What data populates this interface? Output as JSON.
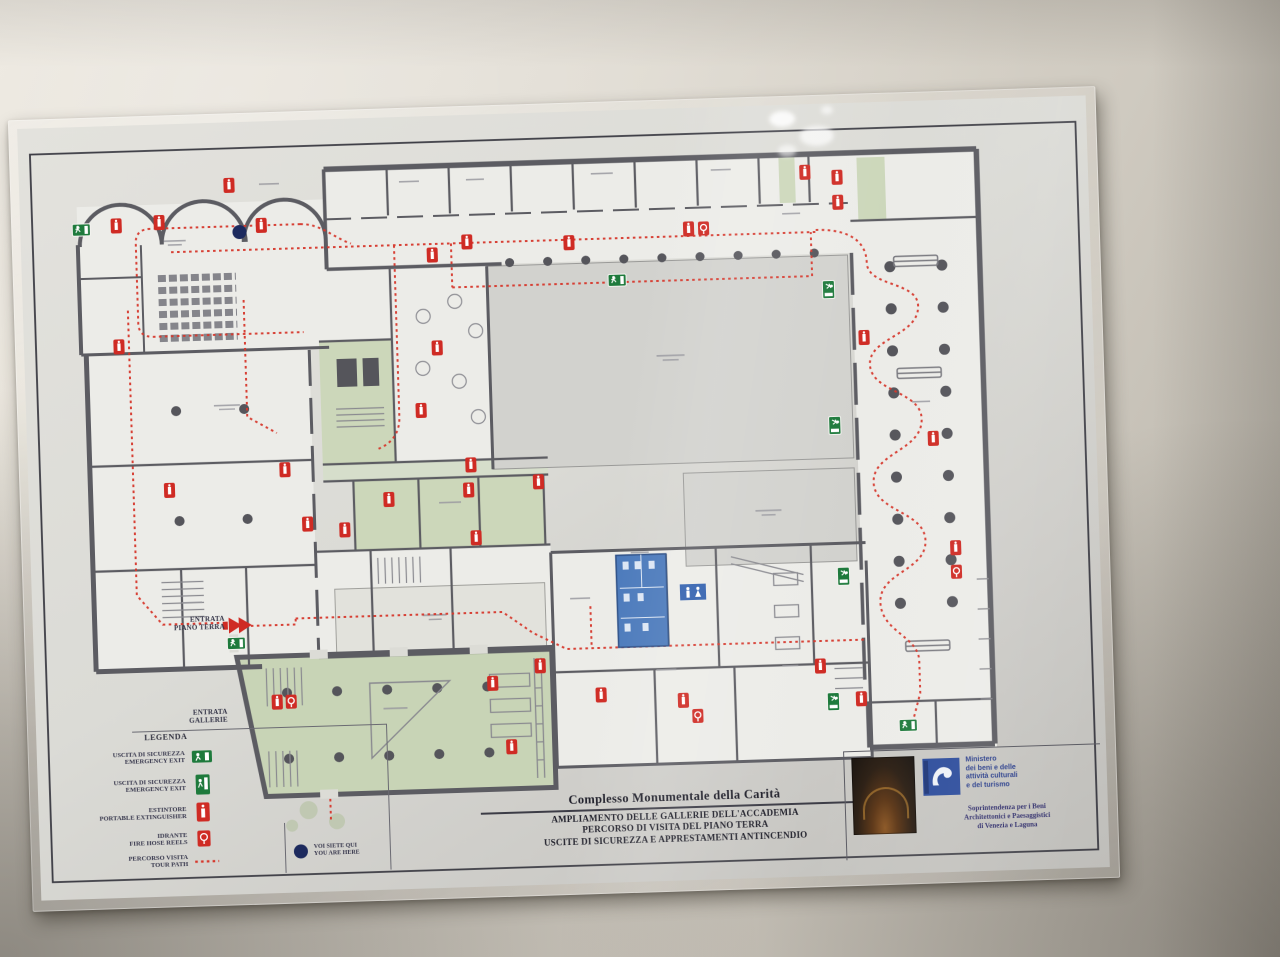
{
  "poster": {
    "entrances": {
      "ground_floor": {
        "line1": "ENTRATA",
        "line2": "PIANO TERRA"
      },
      "galleries": {
        "line1": "ENTRATA",
        "line2": "GALLERIE"
      }
    },
    "legend": {
      "title": "LEGENDA",
      "items": [
        {
          "id": "emergency-exit-horizontal",
          "it": "USCITA DI SICUREZZA",
          "en": "EMERGENCY EXIT"
        },
        {
          "id": "emergency-exit-vertical",
          "it": "USCITA DI SICUREZZA",
          "en": "EMERGENCY EXIT"
        },
        {
          "id": "fire-extinguisher",
          "it": "ESTINTORE",
          "en": "PORTABLE EXTINGUISHER"
        },
        {
          "id": "fire-hose-reel",
          "it": "IDRANTE",
          "en": "FIRE HOSE REELS"
        },
        {
          "id": "tour-path",
          "it": "PERCORSO VISITA",
          "en": "TOUR PATH"
        }
      ],
      "you_are_here": {
        "it": "VOI SIETE QUI",
        "en": "YOU ARE HERE",
        "icon": "blue-dot"
      }
    },
    "title_block": {
      "heading": "Complesso Monumentale della Carità",
      "lines": [
        "AMPLIAMENTO DELLE GALLERIE DELL'ACCADEMIA",
        "PERCORSO DI VISITA DEL PIANO TERRA",
        "USCITE DI SICUREZZA E APPRESTAMENTI ANTINCENDIO"
      ]
    },
    "credits": {
      "ministry_lines": [
        "Ministero",
        "dei beni e delle",
        "attività culturali",
        "e del turismo"
      ],
      "department_lines": [
        "Soprintendenza per i Beni",
        "Architettonici e Paesaggistici",
        "di Venezia e Laguna"
      ]
    },
    "colors": {
      "tour_path_red": "#d6372b",
      "extinguisher_red": "#cf2b24",
      "exit_green": "#1e7a3c",
      "room_green": "#ccd7ba",
      "wc_blue": "#4a79bb",
      "wall_gray": "#5c5c62",
      "courtyard_gray": "#d2d2ce",
      "you_are_here_blue": "#1d2a5e",
      "ministry_blue": "#2b4b9b"
    },
    "icons": [
      "emergency-exit-icon",
      "fire-extinguisher-icon",
      "fire-hose-reel-icon",
      "tour-path-dotted-line",
      "you-are-here-dot",
      "wc-sign-icon",
      "entrance-arrow-icon",
      "ministry-logo",
      "accademia-logo"
    ]
  }
}
